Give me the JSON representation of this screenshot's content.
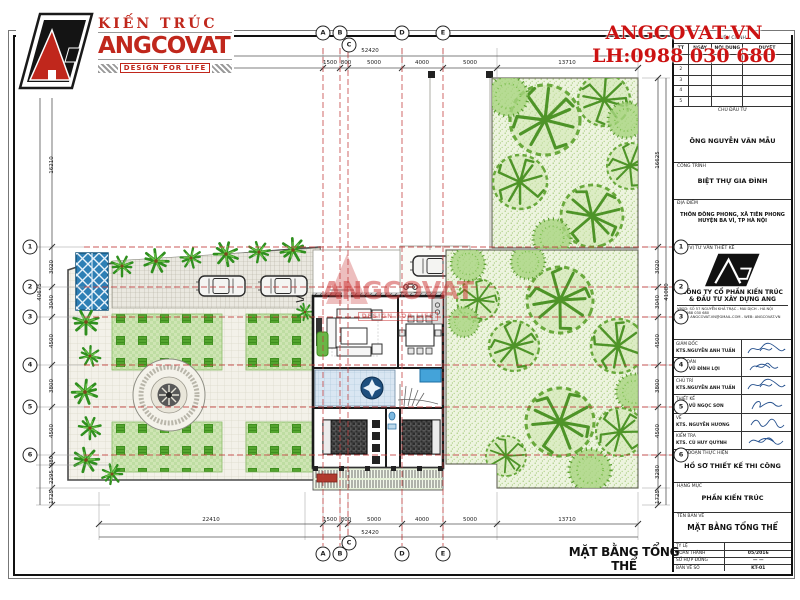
{
  "branding": {
    "kien_truc": "KIẾN TRÚC",
    "angcovat": "ANGCOVAT",
    "tagline": "DESIGN FOR LIFE",
    "website": "ANGCOVAT.VN",
    "hotline": "LH:0988 030 680"
  },
  "watermark": {
    "name": "ANGCOVAT",
    "tagline": "DESIGN FOR LIFE"
  },
  "plan": {
    "title": "MẶT BẰNG TỔNG THỂ",
    "axis_cols": [
      "A",
      "B",
      "C",
      "D",
      "E"
    ],
    "axis_rows": [
      "1",
      "2",
      "3",
      "4",
      "5",
      "6"
    ],
    "dims": {
      "top": [
        "22410",
        "1500",
        "800",
        "5000",
        "4000",
        "5000",
        "13710"
      ],
      "overall": "52420",
      "left": [
        "16210",
        "3020",
        "3040",
        "4500",
        "3800",
        "4500",
        "980",
        "2295",
        "1725"
      ],
      "left_overall": "40675",
      "right": [
        "16625",
        "3020",
        "3040",
        "4500",
        "3800",
        "4500",
        "3280",
        "1725"
      ],
      "right_overall": "41080"
    }
  },
  "titleblock": {
    "revision": {
      "title": "HIỆU CHỈNH",
      "cols": [
        "TT",
        "NGÀY",
        "NỘI DUNG",
        "DUYỆT"
      ],
      "rows": [
        "1",
        "2",
        "3",
        "4",
        "5"
      ]
    },
    "investor_label": "CHỦ ĐẦU TƯ",
    "investor": "ÔNG NGUYỄN VĂN MẪU",
    "project_label": "CÔNG TRÌNH",
    "project": "BIỆT THỰ GIA ĐÌNH",
    "location_label": "ĐỊA ĐIỂM",
    "location1": "THÔN ĐÔNG PHONG, XÃ TIÊN PHONG",
    "location2": "HUYỆN BA VÌ, TP HÀ NỘI",
    "consultant_label": "ĐƠN VỊ TƯ VẤN THIẾT KẾ",
    "company1": "CÔNG TY CỔ PHẦN KIẾN TRÚC",
    "company2": "& ĐẦU TƯ XÂY DỰNG ANG",
    "contact1": "VPGD:  SỐ 57 NGUYỄN KHẢ TRẠC - MAI DỊCH - HÀ NỘI",
    "contact2": "ĐT:      0988 030 680",
    "contact3": "EMAIL: ANGCOVAT.VN@GMAIL.COM - WEB: ANGCOVAT.VN",
    "signatures": [
      {
        "role": "GIÁM ĐỐC",
        "name": "KTS.NGUYỄN ANH TUẤN"
      },
      {
        "role": "CN ĐOÀN",
        "name": "KTS. VŨ ĐÌNH LỢI"
      },
      {
        "role": "CHỦ TRÌ",
        "name": "KTS.NGUYỄN ANH TUẤN"
      },
      {
        "role": "THIẾT KẾ",
        "name": "KTS. VŨ NGỌC SƠN"
      },
      {
        "role": "VẼ",
        "name": "KTS. NGUYỄN HƯƠNG"
      },
      {
        "role": "KIỂM TRA",
        "name": "KTS. CÙ HUY QUỲNH"
      }
    ],
    "stage_label": "GIAI ĐOẠN THỰC HIỆN",
    "stage": "HỒ SƠ THIẾT KẾ THI CÔNG",
    "category_label": "HẠNG MỤC",
    "category": "PHẦN KIẾN TRÚC",
    "drawing_label": "TÊN BẢN VẼ",
    "drawing": "MẶT BẰNG TỔNG THỂ",
    "footer": {
      "scale_label": "TỶ LỆ",
      "scale_value": "",
      "finish_label": "HOÀN THÀNH",
      "finish_value": "05/2016",
      "contract_label": "SỐ HỢP ĐỒNG",
      "contract_value": "—  —",
      "number_label": "BẢN VẼ SỐ",
      "number_value": "KT-01"
    }
  },
  "colors": {
    "accent_red": "#c0271c",
    "axis_red": "#c23b3b",
    "tree_green": "#5aa42c",
    "water_blue": "#2e7fb5"
  }
}
